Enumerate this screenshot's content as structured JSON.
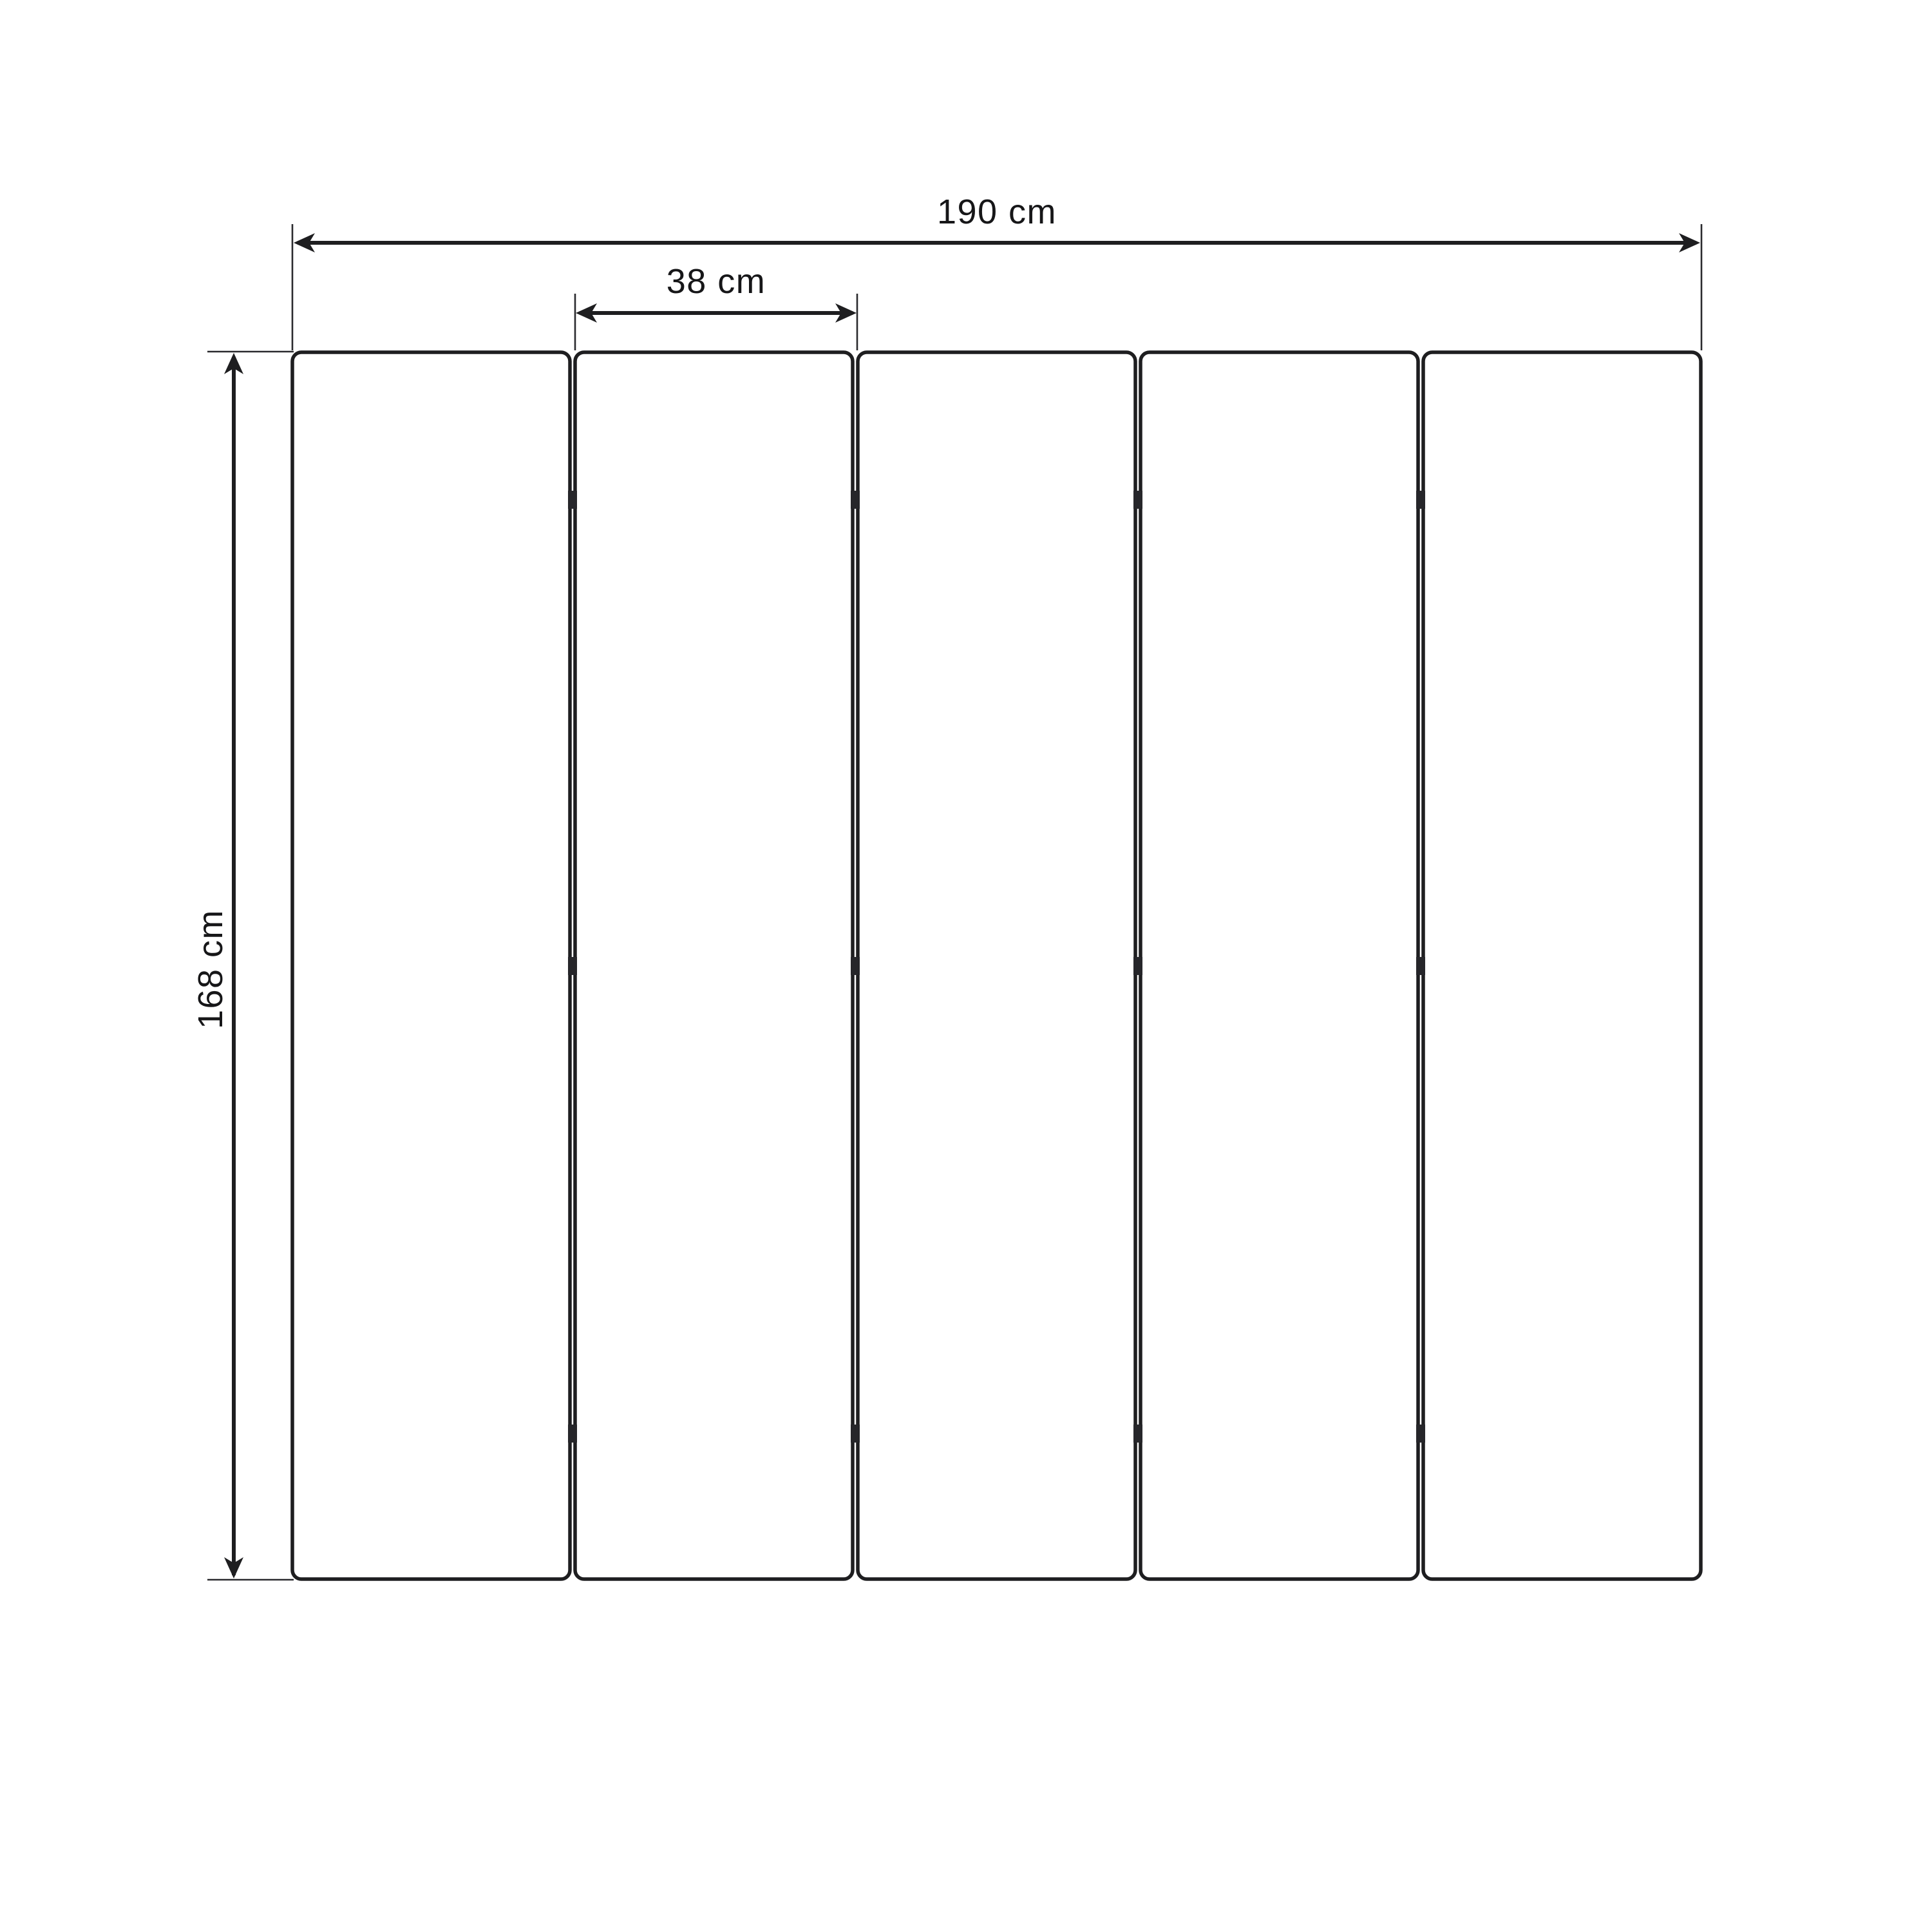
{
  "diagram": {
    "type": "dimension-drawing-folding-screen",
    "panel_count": 5,
    "hinge_rows_per_gap": 3,
    "labels": {
      "total_width": "190 cm",
      "panel_width": "38 cm",
      "height": "168 cm"
    },
    "colors": {
      "line": "#1e1e20",
      "text": "#161618",
      "background": "#ffffff"
    }
  }
}
